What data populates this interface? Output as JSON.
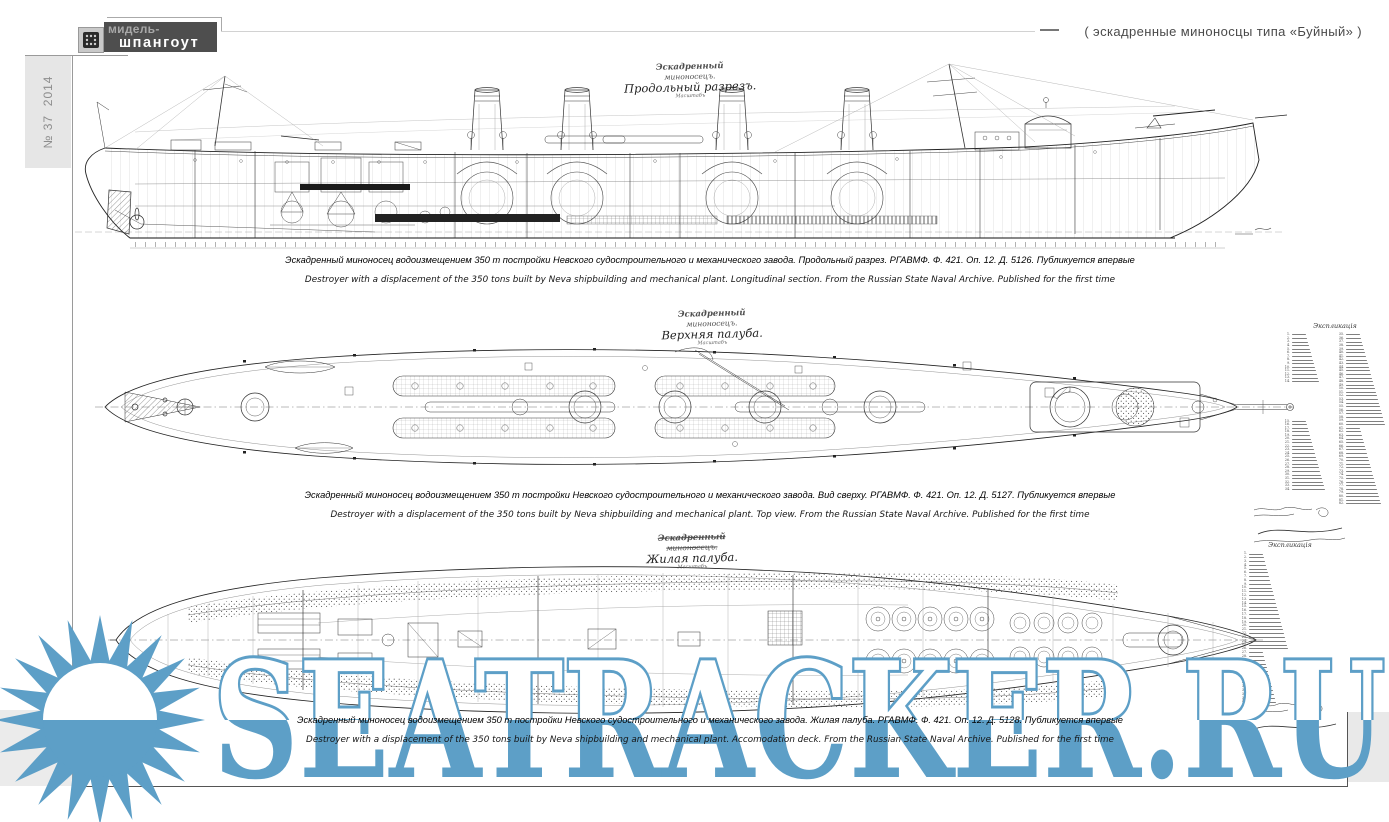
{
  "header": {
    "logo_top": "мидель-",
    "logo_bottom": "шпангоут",
    "series_title": "( эскадренные миноносцы типа «Буйный» )"
  },
  "sidebar": {
    "issue_label": "№ 37",
    "year": "2014"
  },
  "watermark": {
    "site": "SEATRACKER.RU",
    "color": "#5d9fc7"
  },
  "drawings": [
    {
      "name": "longitudinal-section",
      "hand_title": [
        "Эскадренный",
        "миноносецъ.",
        "Продольный разрезъ."
      ],
      "scale_note": "Масштабъ",
      "caption_ru": "Эскадренный миноносец водоизмещением 350 т постройки Невского судостроительного и механического завода. Продольный разрез. РГАВМФ. Ф. 421. Оп. 12. Д. 5126. Публикуется впервые",
      "caption_en": "Destroyer with a displacement of the 350 tons built by Neva shipbuilding and mechanical plant. Longitudinal section. From the Russian State Naval Archive. Published for the first time"
    },
    {
      "name": "upper-deck-plan",
      "hand_title": [
        "Эскадренный",
        "миноносецъ.",
        "Верхняя палуба."
      ],
      "scale_note": "Масштабъ",
      "caption_ru": "Эскадренный миноносец водоизмещением 350 т постройки Невского судостроительного и механического завода. Вид сверху. РГАВМФ. Ф. 421. Оп. 12. Д. 5127. Публикуется впервые",
      "caption_en": "Destroyer with a displacement of the 350 tons built by Neva shipbuilding and mechanical plant. Top view. From the Russian State Naval Archive. Published for the first time",
      "legend": {
        "title": "Экспликація",
        "groups": [
          {
            "start": 1,
            "count": 14
          },
          {
            "start": 15,
            "count": 20
          },
          {
            "start": 35,
            "count": 48
          }
        ]
      }
    },
    {
      "name": "accommodation-deck-plan",
      "hand_title": [
        "Эскадренный",
        "миноносецъ.",
        "Жилая палуба."
      ],
      "scale_note": "Масштабъ",
      "caption_ru": "Эскадренный миноносец водоизмещением 350 т постройки Невского судостроительного и механического завода. Жилая палуба. РГАВМФ. Ф. 421. Оп. 12. Д. 5128. Публикуется впервые",
      "caption_en": "Destroyer with a displacement of the 350 tons built by Neva shipbuilding and mechanical plant. Accomodation deck. From the Russian State Naval Archive. Published for the first time",
      "legend": {
        "title": "Экспликація",
        "groups": [
          {
            "start": 1,
            "count": 40
          }
        ]
      }
    }
  ]
}
